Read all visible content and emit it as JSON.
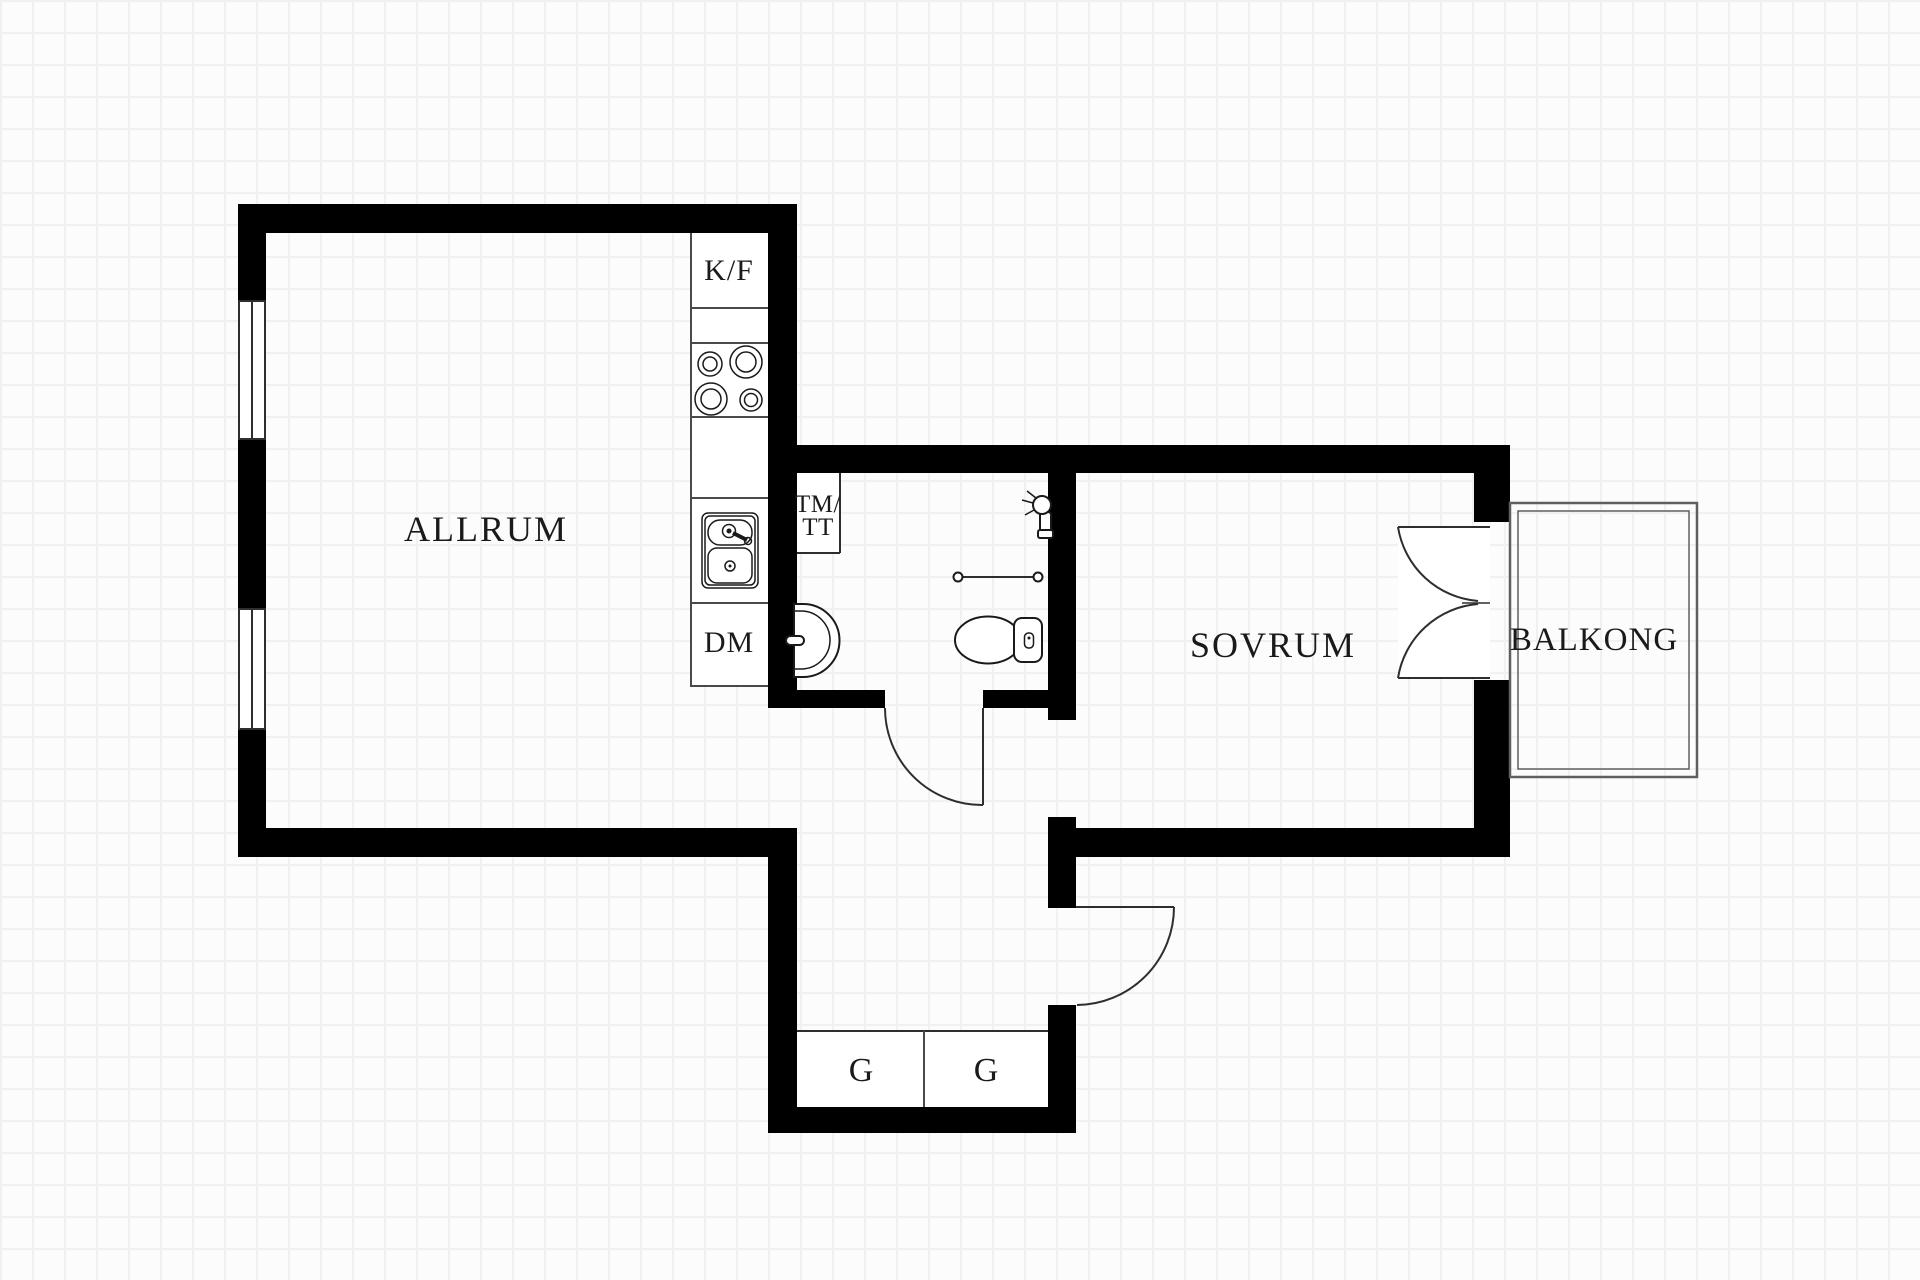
{
  "floorplan": {
    "labels": {
      "living_room": "ALLRUM",
      "bedroom": "SOVRUM",
      "balcony": "BALKONG",
      "fridge_freezer": "K/F",
      "washer_dryer_line1": "TM/",
      "washer_dryer_line2": "TT",
      "dishwasher": "DM",
      "wardrobe_left": "G",
      "wardrobe_right": "G"
    },
    "colors": {
      "wall": "#000000",
      "line": "#2e2e2e",
      "fixture": "#1a1a1a",
      "kitchen_line": "#4a4a4a",
      "balcony_line": "#5f5f5f",
      "grid": "#f1f1f1",
      "background": "#fcfcfc",
      "text": "#1a1a1a"
    }
  }
}
